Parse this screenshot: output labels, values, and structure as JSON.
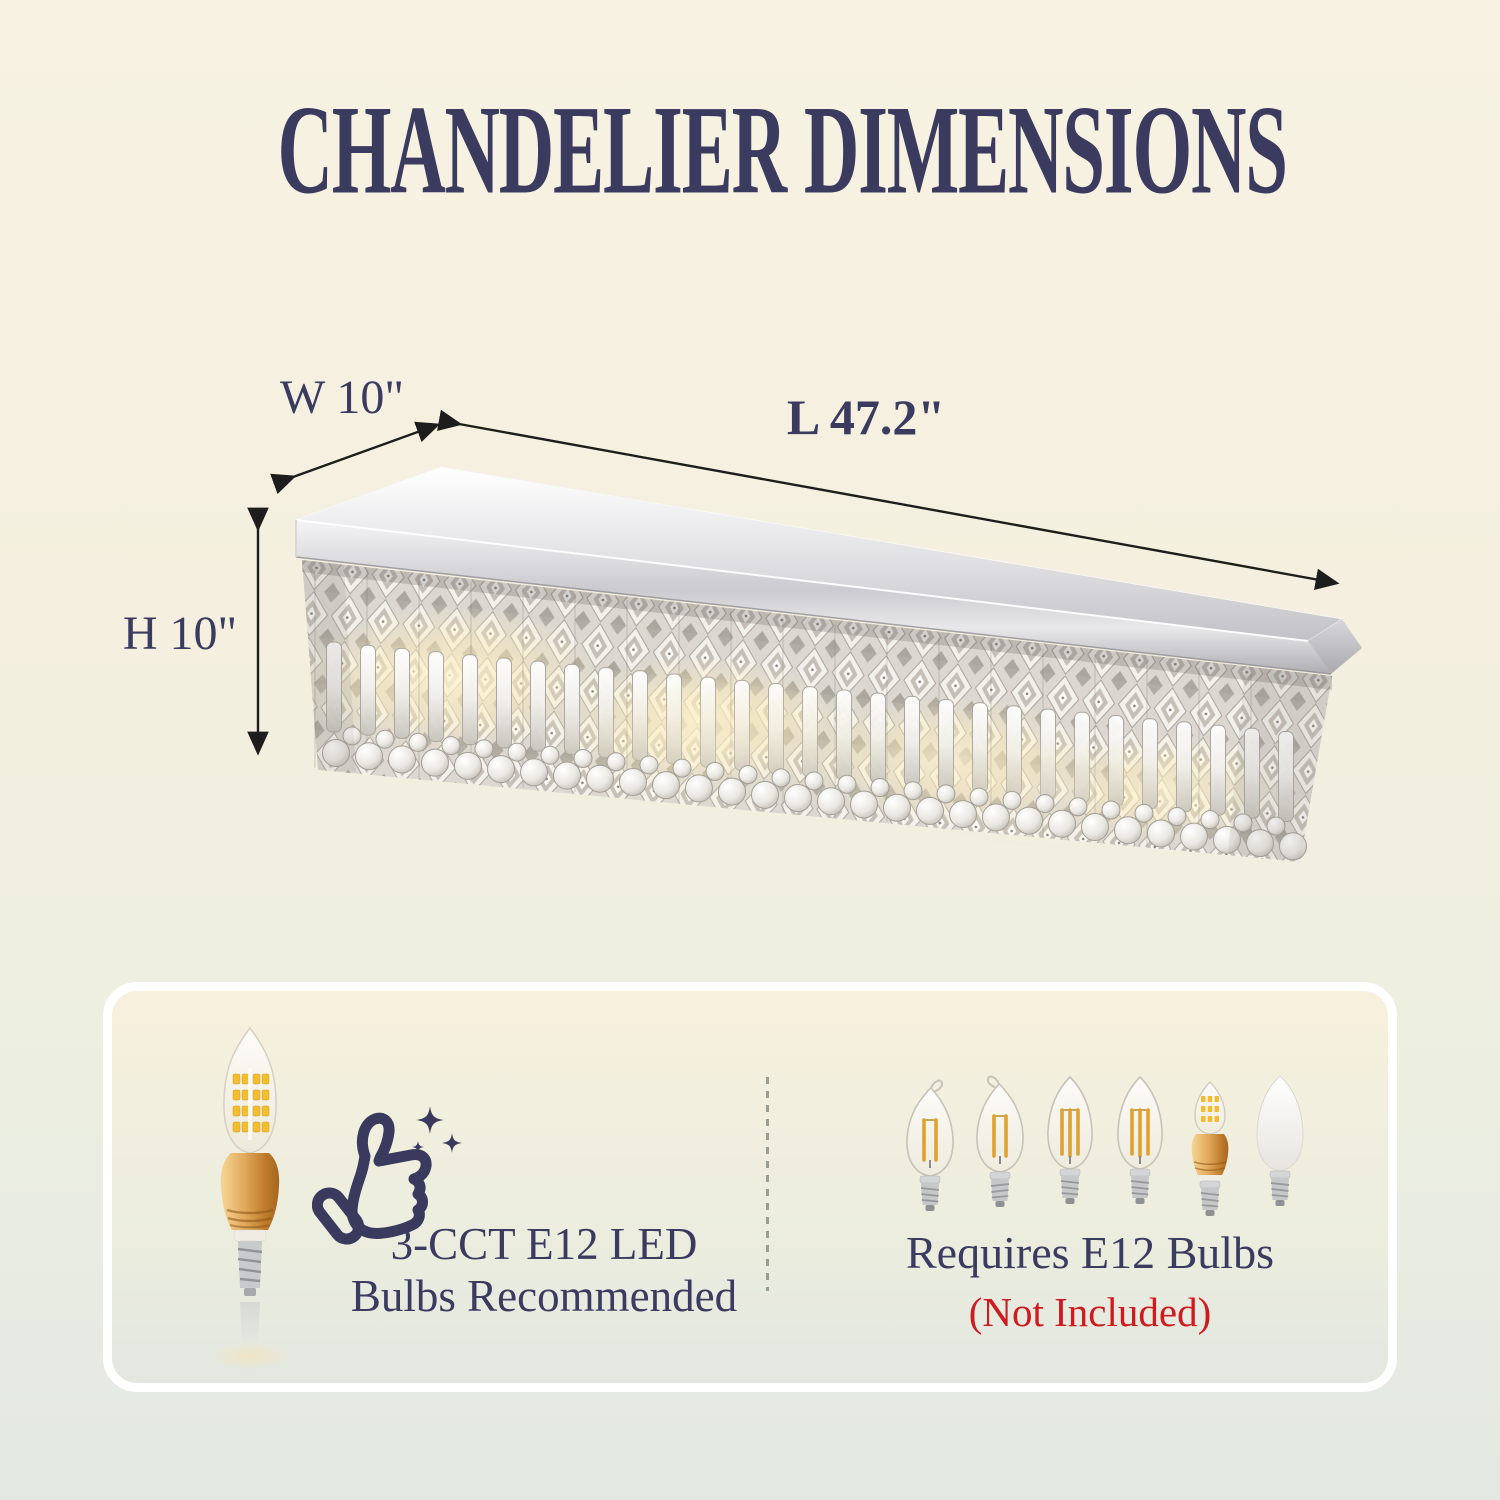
{
  "title": "CHANDELIER DIMENSIONS",
  "dimensions": {
    "width": "W 10\"",
    "length": "L 47.2\"",
    "height": "H 10\""
  },
  "card": {
    "recommended": {
      "line1": "3-CCT E12 LED",
      "line2": "Bulbs Recommended"
    },
    "required": {
      "line1": "Requires E12 Bulbs",
      "line2": "(Not Included)"
    }
  },
  "icons": {
    "thumbs-up-icon": "outlined thumbs-up with sparkles",
    "sparkles-icon": "four-point stars",
    "dimension-arrow-icon": "double-headed black arrow",
    "recommended-bulb-icon": "gold E12 LED candle bulb photo",
    "required-bulb-icons": [
      "flame-tip-clear-filament",
      "flame-tip-clear-filament",
      "torpedo-clear-filament",
      "torpedo-clear-filament",
      "gold-led-candle",
      "frosted-white-torpedo"
    ],
    "product-image": "rectangular crystal raindrop chandelier with chrome canopy"
  },
  "colors": {
    "navy": "#3b3b60",
    "red": "#cf1b1f",
    "arrow": "#1d1d1d",
    "background_top": "#f7f2e2",
    "background_bottom": "#e3e8e2",
    "card_border": "#ffffff",
    "chrome": "#c9c9cd",
    "gold": "#d99a4a",
    "warm_glow": "#ffedb8"
  }
}
